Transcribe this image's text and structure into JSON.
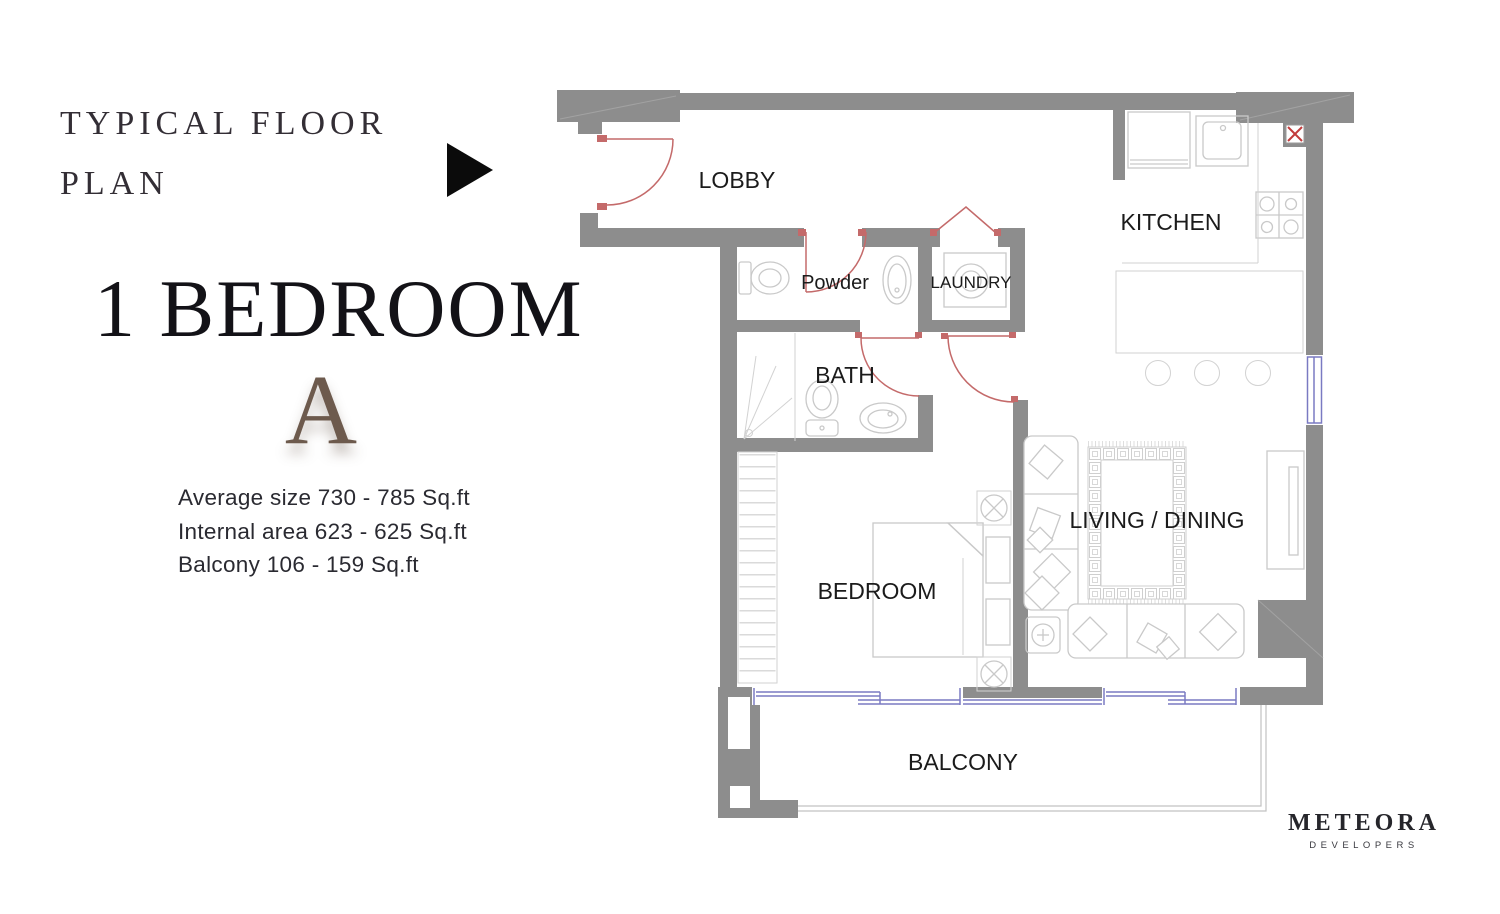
{
  "page": {
    "heading": {
      "line1": "TYPICAL FLOOR",
      "line2": "PLAN"
    },
    "unit": {
      "title": "1 BEDROOM",
      "variant": "A"
    },
    "stats": [
      "Average size 730 - 785 Sq.ft",
      "Internal area 623 - 625 Sq.ft",
      "Balcony 106 - 159 Sq.ft"
    ]
  },
  "floorplan": {
    "rooms": {
      "lobby": "LOBBY",
      "powder": "Powder",
      "laundry": "LAUNDRY",
      "kitchen": "KITCHEN",
      "bath": "BATH",
      "bedroom": "BEDROOM",
      "living_dining": "LIVING / DINING",
      "balcony": "BALCONY"
    },
    "colors": {
      "wall": "#8d8d8d",
      "door_swing": "#c46a6a",
      "window": "#7a7ac2",
      "furniture_line": "#c9c9c9",
      "label_text": "#1b1b1b",
      "shaft_x": "#c23b3b"
    }
  },
  "logo": {
    "brand": "METEORA",
    "tagline": "DEVELOPERS"
  }
}
